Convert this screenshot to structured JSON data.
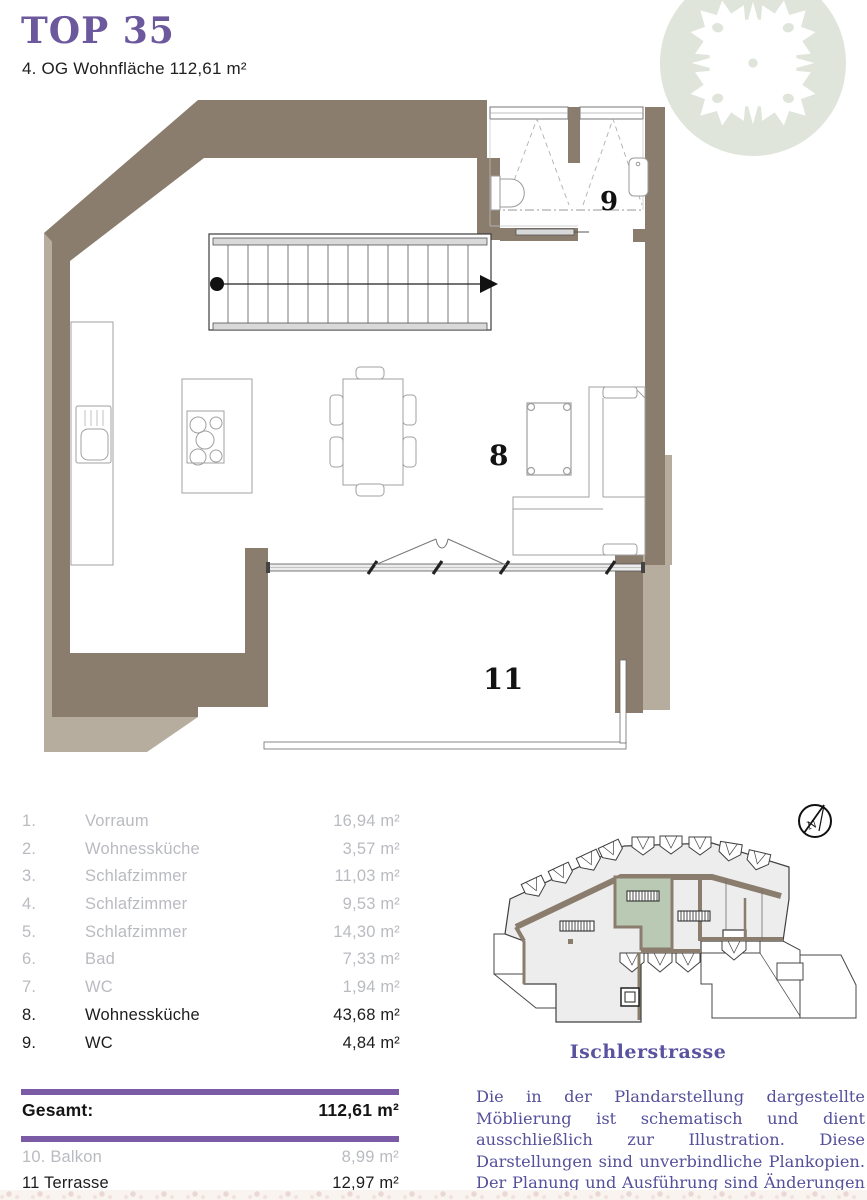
{
  "colors": {
    "accent_purple": "#7b5ba6",
    "title_purple": "#6c589d",
    "text_purple": "#54509a",
    "wall_dark": "#8a7d6d",
    "wall_light": "#b6ad9f",
    "logo_green": "#dfe5db",
    "unit_green": "#b9c9b3",
    "muted_gray": "#b9bbc0",
    "ink": "#1d1d1f"
  },
  "header": {
    "title": "TOP 35",
    "subtitle": "4. OG Wohnfläche 112,61 m²"
  },
  "plan": {
    "labels": {
      "living": "8",
      "wc": "9",
      "terrace": "11"
    }
  },
  "rooms": {
    "rows": [
      {
        "num": "1.",
        "name": "Vorraum",
        "area": "16,94 m²"
      },
      {
        "num": "2.",
        "name": "Wohnessküche",
        "area": "3,57 m²"
      },
      {
        "num": "3.",
        "name": "Schlafzimmer",
        "area": "11,03 m²"
      },
      {
        "num": "4.",
        "name": "Schlafzimmer",
        "area": "9,53 m²"
      },
      {
        "num": "5.",
        "name": "Schlafzimmer",
        "area": "14,30 m²"
      },
      {
        "num": "6.",
        "name": "Bad",
        "area": "7,33 m²"
      },
      {
        "num": "7.",
        "name": "WC",
        "area": "1,94 m²"
      },
      {
        "num": "8.",
        "name": "Wohnessküche",
        "area": "43,68 m²"
      },
      {
        "num": "9.",
        "name": "WC",
        "area": "4,84 m²"
      }
    ]
  },
  "total": {
    "label": "Gesamt:",
    "value": "112,61 m²"
  },
  "outdoor": {
    "rows": [
      {
        "label": "10. Balkon",
        "area": "8,99 m²"
      },
      {
        "label": "11 Terrasse",
        "area": "12,97 m²"
      }
    ]
  },
  "site": {
    "street": "Ischlerstrasse",
    "north_label": "N"
  },
  "disclaimer": "Die in der Plandarstellung dargestellte Möblierung ist schematisch und dient ausschließlich zur Illustration. Diese Darstellungen sind unverbindliche Plankopien. Der Planung und Ausführung sind Änderungen vorbehalten. Sämtliche Maße sind Rohbaumaße."
}
